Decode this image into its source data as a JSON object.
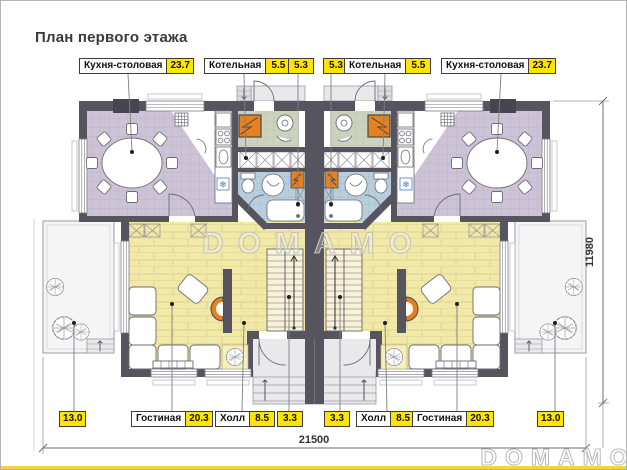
{
  "title": "План первого этажа",
  "watermark": {
    "center": "DOMAMO",
    "corner": "DOMAMO"
  },
  "dimensions": {
    "width": "21500",
    "depth": "11980"
  },
  "rooms": {
    "kitchen": {
      "label": "Кухня-столовая",
      "area": "23.7"
    },
    "boiler": {
      "label": "Котельная",
      "area": "5.5"
    },
    "bath": {
      "area": "5.3"
    },
    "living": {
      "label": "Гостиная",
      "area": "20.3"
    },
    "hall": {
      "label": "Холл",
      "area": "8.5"
    },
    "stairs": {
      "area": "3.3"
    },
    "terrace": {
      "area": "13.0"
    }
  },
  "colors": {
    "area_badge": "#ffe400",
    "wall": "#56545f",
    "kitchen_floor": "#cdc3d6",
    "boiler_floor": "#ccd3bd",
    "bath_floor": "#b9cedd",
    "living_floor": "#f2e9a8",
    "boiler_unit": "#e5821f",
    "accent_strip": "#eed73c"
  }
}
